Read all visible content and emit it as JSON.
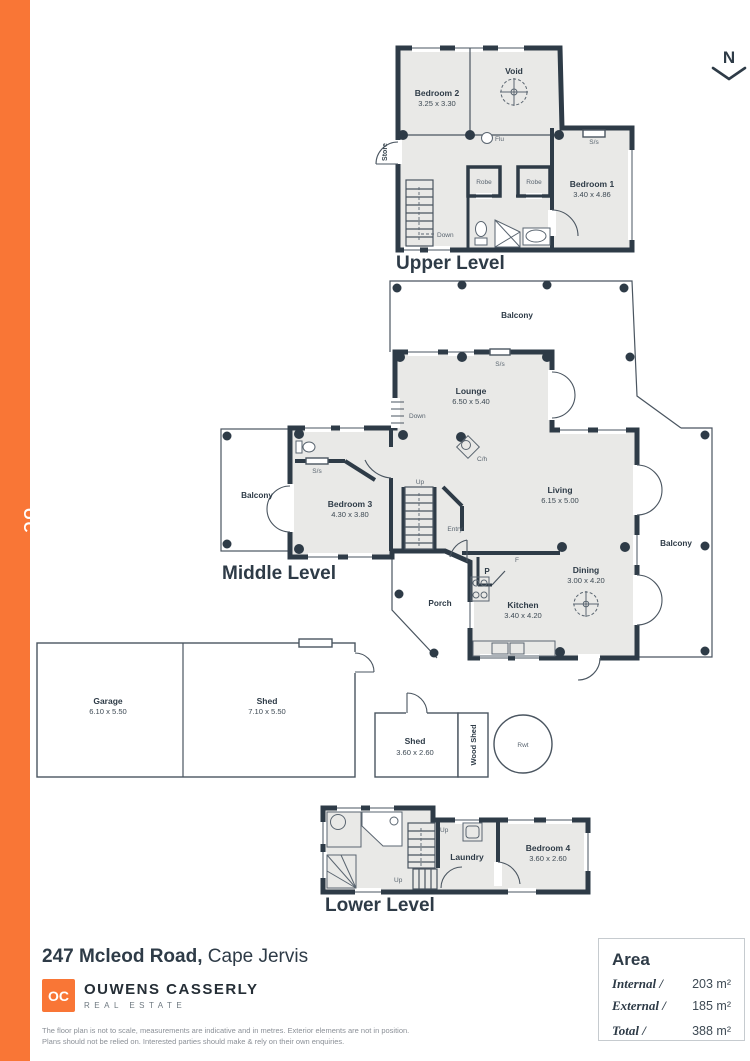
{
  "page": {
    "accent_orange": "#F97636",
    "wall_color": "#2E3B47",
    "floor_color": "#E9E9E7"
  },
  "sidebar": {
    "logo_text": "OC"
  },
  "compass": {
    "label": "N"
  },
  "levels": {
    "upper": {
      "title": "Upper Level",
      "bedroom2_name": "Bedroom 2",
      "bedroom2_dims": "3.25 x 3.30",
      "void_name": "Void",
      "bedroom1_name": "Bedroom 1",
      "bedroom1_dims": "3.40 x 4.86",
      "robe1": "Robe",
      "robe2": "Robe",
      "store": "Store",
      "down": "Down",
      "flu": "Flu",
      "ss": "S/s"
    },
    "middle": {
      "title": "Middle Level",
      "balcony_top": "Balcony",
      "balcony_left": "Balcony",
      "balcony_right": "Balcony",
      "lounge_name": "Lounge",
      "lounge_dims": "6.50 x 5.40",
      "living_name": "Living",
      "living_dims": "6.15 x 5.00",
      "bedroom3_name": "Bedroom 3",
      "bedroom3_dims": "4.30 x 3.80",
      "dining_name": "Dining",
      "dining_dims": "3.00 x 4.20",
      "kitchen_name": "Kitchen",
      "kitchen_dims": "3.40 x 4.20",
      "porch": "Porch",
      "entry": "Entry",
      "down": "Down",
      "up": "Up",
      "ch": "C/h",
      "ss_lounge": "S/s",
      "ss_bath": "S/s",
      "pantry": "P",
      "fridge": "F"
    },
    "outbuildings": {
      "garage_name": "Garage",
      "garage_dims": "6.10 x 5.50",
      "shed_large_name": "Shed",
      "shed_large_dims": "7.10 x 5.50",
      "shed_small_name": "Shed",
      "shed_small_dims": "3.60 x 2.60",
      "wood_shed": "Wood Shed",
      "rwt": "Rwt"
    },
    "lower": {
      "title": "Lower Level",
      "laundry": "Laundry",
      "bedroom4_name": "Bedroom 4",
      "bedroom4_dims": "3.60 x 2.60",
      "up1": "Up",
      "up2": "Up"
    }
  },
  "footer": {
    "address_bold": "247 Mcleod Road,",
    "address_suffix": " Cape Jervis",
    "brand": {
      "initials": "OC",
      "name": "OUWENS CASSERLY",
      "tagline": "REAL ESTATE"
    },
    "disclaimer_line1": "The floor plan is not to scale, measurements are indicative and in metres. Exterior elements are not in position.",
    "disclaimer_line2": "Plans should not be relied on. Interested parties should make & rely on their own enquiries.",
    "area": {
      "title": "Area",
      "rows": [
        {
          "label": "Internal /",
          "value": "203 m²"
        },
        {
          "label": "External /",
          "value": "185 m²"
        },
        {
          "label": "Total /",
          "value": "388 m²"
        }
      ]
    }
  }
}
